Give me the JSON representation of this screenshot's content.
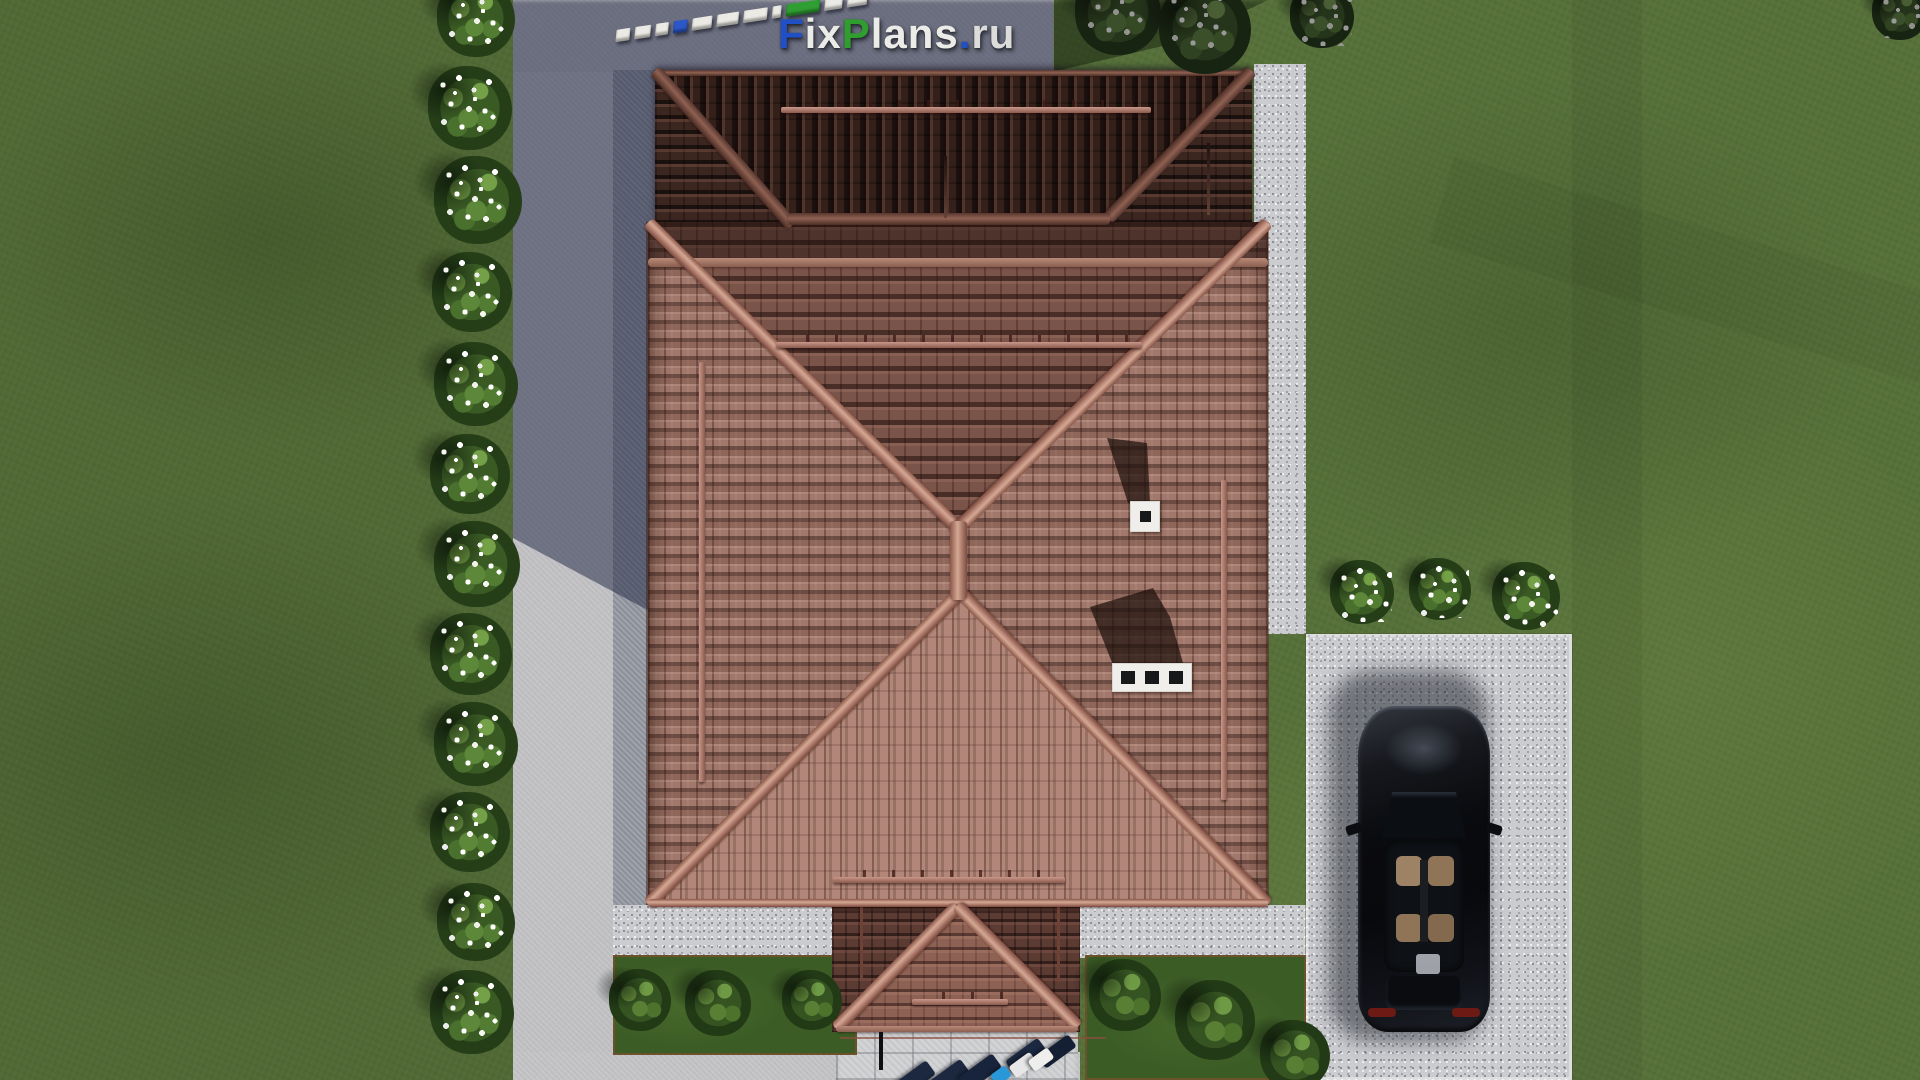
{
  "watermark": {
    "text": "FixPlans.ru",
    "letters": [
      {
        "ch": "F",
        "color": "#2050c8"
      },
      {
        "ch": "i",
        "color": "#ebebe8"
      },
      {
        "ch": "x",
        "color": "#ebebe8"
      },
      {
        "ch": "P",
        "color": "#2f9e2f"
      },
      {
        "ch": "l",
        "color": "#ebebe8"
      },
      {
        "ch": "a",
        "color": "#ebebe8"
      },
      {
        "ch": "n",
        "color": "#ebebe8"
      },
      {
        "ch": "s",
        "color": "#ebebe8"
      },
      {
        "ch": ".",
        "color": "#2050c8"
      },
      {
        "ch": "r",
        "color": "#dcdcda"
      },
      {
        "ch": "u",
        "color": "#dcdcda"
      }
    ]
  },
  "scale_ruler": {
    "segment_colors": [
      "white",
      "white",
      "white",
      "blue",
      "white",
      "white",
      "white",
      "white",
      "green",
      "white",
      "white"
    ],
    "palette": {
      "white": "#eceae4",
      "blue": "#2b57c9",
      "green": "#2f9e33"
    }
  },
  "scene": {
    "palette": {
      "grass": "#57713a",
      "path_sunlit": "#c4c4c7",
      "path_in_shadow": "#6f7489",
      "gravel_apron": "#cbccd0",
      "roof_tiles": "#a1786b",
      "roof_ridge_caps": "#d4a794",
      "roof_shaded_slope": "#2e1c17",
      "chimney_white": "#efeeea",
      "car_black": "#0b0c0f",
      "shrub_flowers": "#ffffff",
      "shrub_green": "#3a5a24"
    },
    "objects": [
      "tiled hip roof",
      "garage roof wing",
      "porch roof",
      "two chimneys",
      "snow guard rails",
      "driveway in house shadow",
      "garden path",
      "gravel apron",
      "parking pad",
      "black car",
      "white flowering shrubs",
      "green shrubs",
      "terrace furniture",
      "scale ruler",
      "watermark logo"
    ]
  }
}
